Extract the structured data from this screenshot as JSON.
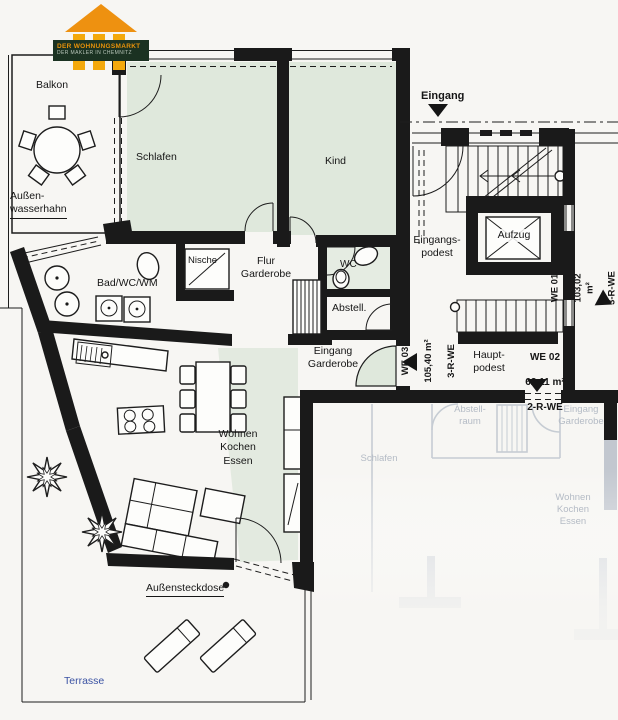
{
  "logo": {
    "tagline1": "DER WOHNUNGSMARKT",
    "tagline2": "DER MAKLER IN CHEMNITZ"
  },
  "labels": {
    "balkon": "Balkon",
    "aussenwasserhahn": "Außen-\nwasserhahn",
    "schlafen": "Schlafen",
    "kind": "Kind",
    "eingang": "Eingang",
    "eingangspodest": "Eingangs-\npodest",
    "aufzug": "Aufzug",
    "nische": "Nische",
    "flur_garderobe": "Flur\nGarderobe",
    "wc": "WC",
    "abstell": "Abstell.",
    "bad": "Bad/WC/WM",
    "eingang_garderobe": "Eingang\nGarderobe",
    "hauptpodest": "Haupt-\npodest",
    "wohnen": "Wohnen\nKochen\nEssen",
    "aussensteckdose": "Außensteckdose",
    "terrasse": "Terrasse"
  },
  "units": {
    "we01": {
      "id": "WE 01",
      "area": "103,02 m²",
      "rooms": "3-R-WE"
    },
    "we02": {
      "id": "WE 02",
      "area": "62,11 m²",
      "rooms": "2-R-WE"
    },
    "we03": {
      "id": "WE 03",
      "area": "105,40 m²",
      "rooms": "3-R-WE"
    }
  },
  "faded_apartment": {
    "abstellraum": "Abstell-\nraum",
    "eingang_garderobe": "Eingang\nGarderobe",
    "schlafen": "Schlafen",
    "wohnen": "Wohnen\nKochen\nEssen"
  },
  "colors": {
    "wall": "#1a1a1a",
    "room_tint": "#dfe8dc",
    "terrace_label": "#3a52a3",
    "faded_line": "#c6ccd3",
    "faded_text": "#b4bbc5",
    "logo_orange": "#ee9110",
    "logo_yellow": "#f3a90c",
    "logo_green": "#1b3222",
    "logo_tagline_orange": "#e8920a"
  }
}
